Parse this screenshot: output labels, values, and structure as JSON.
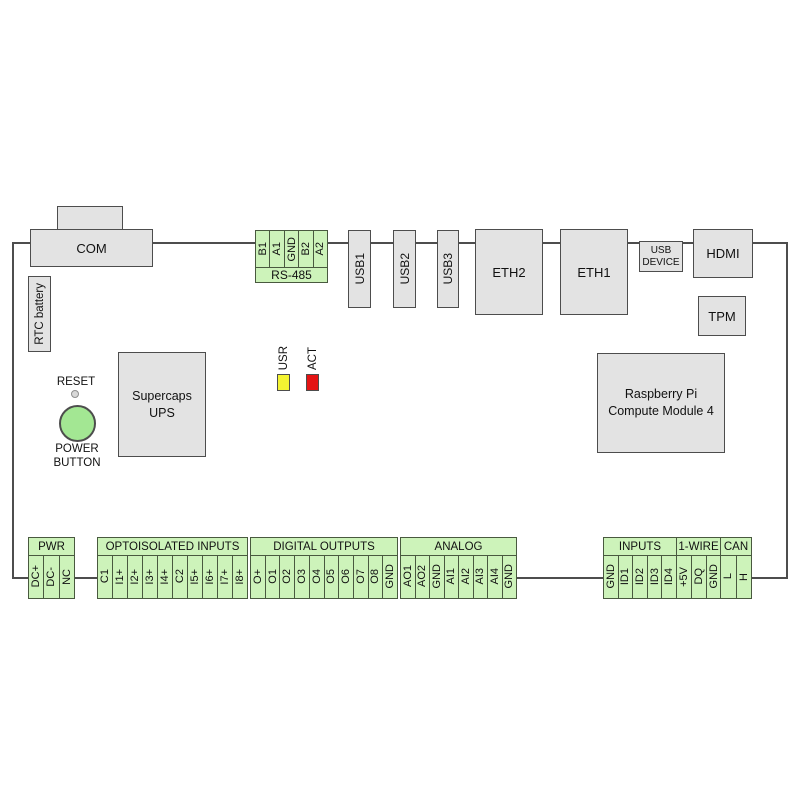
{
  "colors": {
    "block_green": "#cdf3ba",
    "box_gray": "#e3e3e3",
    "outline": "#4d4d4d",
    "led_usr_fill": "#f4f432",
    "led_act_fill": "#e41414",
    "power_button_fill": "#a3e793"
  },
  "connectors": {
    "com": "COM",
    "rtc_battery": "RTC battery",
    "usb1": "USB1",
    "usb2": "USB2",
    "usb3": "USB3",
    "eth2": "ETH2",
    "eth1": "ETH1",
    "usb_device": {
      "line1": "USB",
      "line2": "DEVICE"
    },
    "hdmi": "HDMI",
    "tpm": "TPM"
  },
  "rs485": {
    "label": "RS-485",
    "terminals": [
      "B1",
      "A1",
      "GND",
      "B2",
      "A2"
    ]
  },
  "center": {
    "reset": "RESET",
    "power_button": {
      "line1": "POWER",
      "line2": "BUTTON"
    },
    "supercaps": {
      "line1": "Supercaps",
      "line2": "UPS"
    },
    "cm4": {
      "line1": "Raspberry Pi",
      "line2": "Compute Module 4"
    },
    "leds": [
      {
        "label": "USR"
      },
      {
        "label": "ACT"
      }
    ]
  },
  "bottom_blocks": [
    {
      "label": "PWR",
      "terminals": [
        "DC+",
        "DC-",
        "NC"
      ]
    },
    {
      "label": "OPTOISOLATED INPUTS",
      "terminals": [
        "C1",
        "I1+",
        "I2+",
        "I3+",
        "I4+",
        "C2",
        "I5+",
        "I6+",
        "I7+",
        "I8+"
      ]
    },
    {
      "label": "DIGITAL OUTPUTS",
      "terminals": [
        "O+",
        "O1",
        "O2",
        "O3",
        "O4",
        "O5",
        "O6",
        "O7",
        "O8",
        "GND"
      ]
    },
    {
      "label": "ANALOG",
      "terminals": [
        "AO1",
        "AO2",
        "GND",
        "AI1",
        "AI2",
        "AI3",
        "AI4",
        "GND"
      ]
    },
    {
      "label": "INPUTS",
      "terminals": [
        "GND",
        "ID1",
        "ID2",
        "ID3",
        "ID4"
      ]
    },
    {
      "label": "1-WIRE",
      "terminals": [
        "+5V",
        "DQ",
        "GND"
      ]
    },
    {
      "label": "CAN",
      "terminals": [
        "L",
        "H"
      ]
    }
  ]
}
